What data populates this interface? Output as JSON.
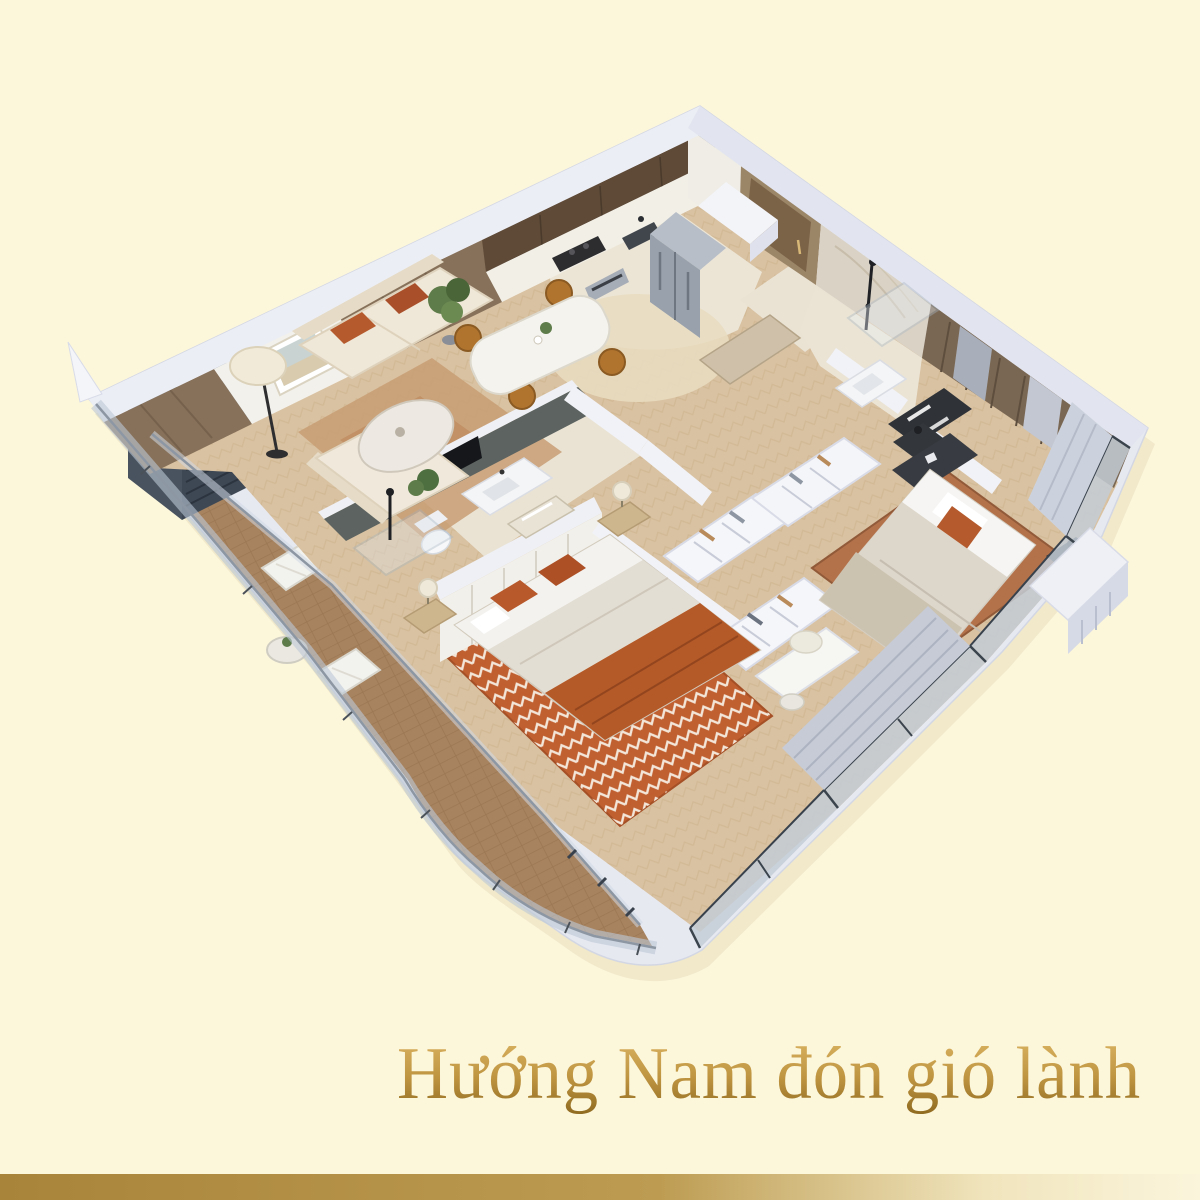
{
  "background": "#FCF6DB",
  "caption": {
    "text": "Hướng Nam đón gió lành",
    "gold_top": "#DDB765",
    "gold_mid": "#BE9440",
    "gold_dark": "#8E6A20"
  },
  "bottom_bar": {
    "left": "#A8843A",
    "mid": "#BD9C52",
    "fade": "#F0E4BC",
    "right": "#FBF5DC"
  },
  "palette": {
    "slab": "#E7E9F1",
    "wall_top": "#ECEEF5",
    "wood_floor": "#D9C2A2",
    "tile": "#ECE5D6",
    "deck": "#A8835F",
    "panel_wood": "#87715A",
    "cabinet_brown": "#5E4A37",
    "slate_wall": "#5C6360",
    "sofa_cream": "#EFE7D7",
    "accent_rust": "#B55A2C",
    "blanket_orange": "#B45A28",
    "chair_mustard": "#B0742F",
    "glass": "#BCC8D6",
    "curtain": "#C6CBD6",
    "marble": "#DAD2C4",
    "rug_master": "#B06A42",
    "rug_bedroom2": "#BF5A2A"
  }
}
